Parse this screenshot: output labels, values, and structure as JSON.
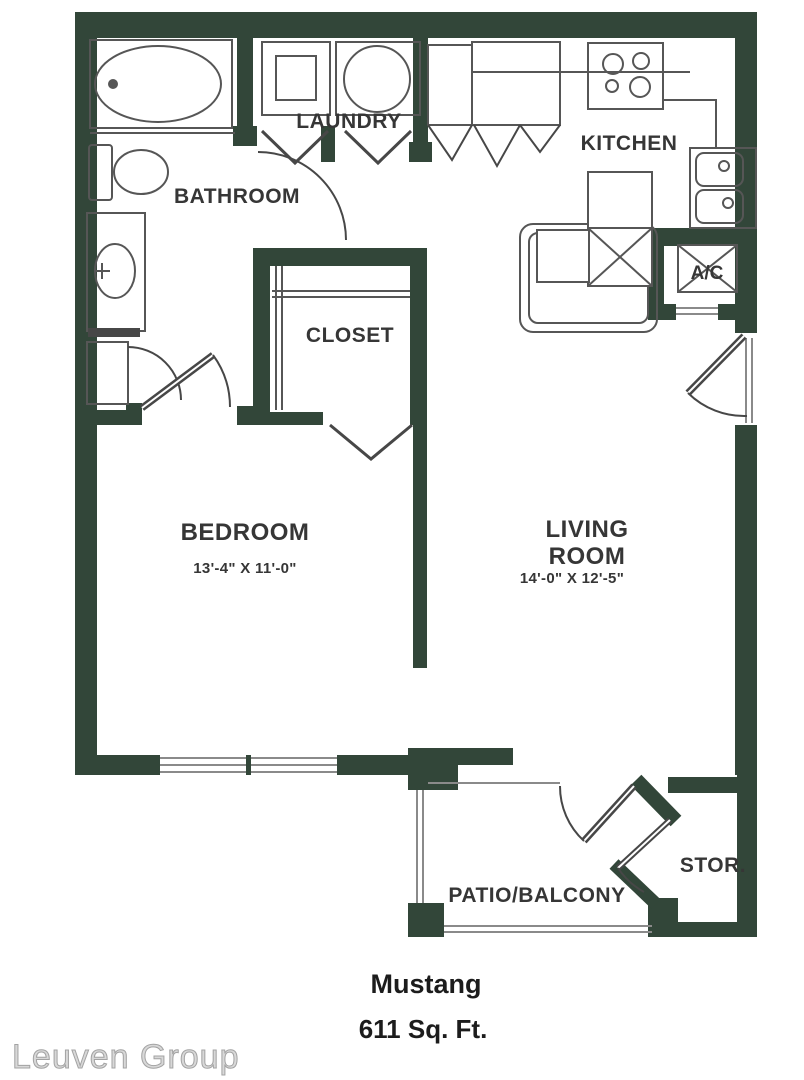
{
  "page": {
    "title": "Mustang",
    "area": "611 Sq. Ft.",
    "watermark": "Leuven Group"
  },
  "colors": {
    "wall": "#324639",
    "fixture_line": "#565656",
    "door_line": "#474747",
    "glass_line": "#8a8a8a",
    "label_text": "#363636",
    "title_text": "#1c1c1c",
    "watermark_fill": "#d8d8d8",
    "watermark_stroke": "#a3a3a3",
    "background": "#ffffff"
  },
  "rooms": {
    "laundry": {
      "label": "LAUNDRY"
    },
    "bathroom": {
      "label": "BATHROOM"
    },
    "kitchen": {
      "label": "KITCHEN"
    },
    "closet": {
      "label": "CLOSET"
    },
    "bedroom": {
      "label": "BEDROOM",
      "dims": "13'-4\" X 11'-0\""
    },
    "living": {
      "line1": "LIVING",
      "line2": "ROOM",
      "dims": "14'-0\" X 12'-5\""
    },
    "ac": {
      "label": "A/C"
    },
    "storage": {
      "label": "STOR."
    },
    "patio": {
      "label": "PATIO/BALCONY"
    }
  }
}
